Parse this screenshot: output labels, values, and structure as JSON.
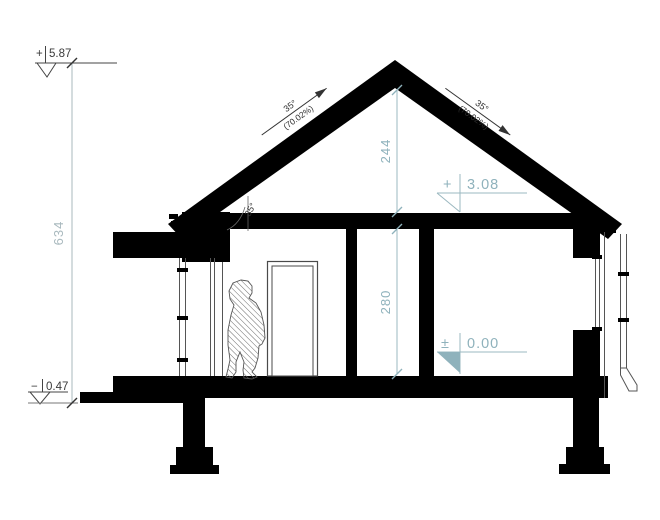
{
  "drawing": {
    "type": "architectural-cross-section",
    "colors": {
      "ink": "#000000",
      "dim_accent_teal": "#8fb2bc",
      "dim_muted_gray": "#a9b9be",
      "outline_gray": "#555555",
      "background": "#ffffff"
    },
    "left_dim": {
      "total_height": "634"
    },
    "levels": {
      "ridge_sign": "+",
      "ridge_value": "5.87",
      "attic_sign": "+",
      "attic_value": "3.08",
      "floor_sign": "±",
      "floor_value": "0.00",
      "terrain_sign": "−",
      "terrain_value": "0.47"
    },
    "interior_dims": {
      "attic_height": "244",
      "room_height": "280"
    },
    "roof": {
      "left_angle": "35°",
      "left_percent": "(70.02%)",
      "right_angle": "35°",
      "right_percent": "(70.02%)",
      "eave_angle": "35°"
    }
  }
}
